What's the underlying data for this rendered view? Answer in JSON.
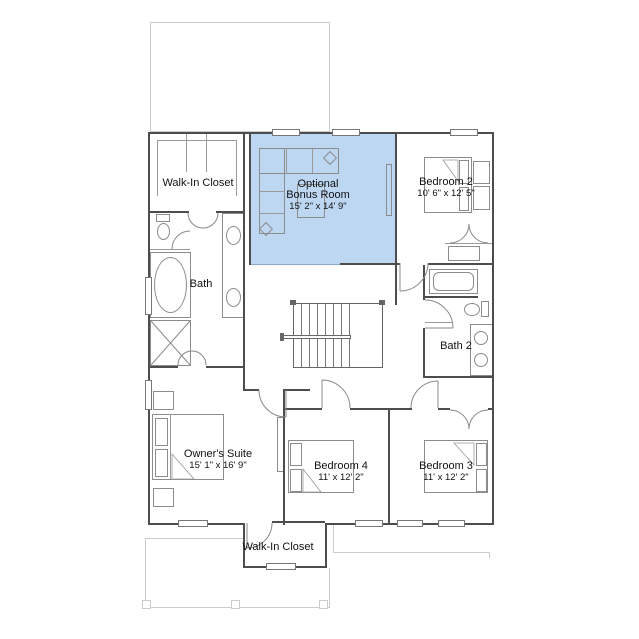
{
  "floorplan": {
    "rooms": {
      "walk_in_closet_upper": {
        "name": "Walk-In Closet"
      },
      "bonus_room": {
        "name_line1": "Optional",
        "name_line2": "Bonus Room",
        "dimensions": "15' 2\" x 14' 9\"",
        "is_highlighted_option": true
      },
      "bedroom_2": {
        "name": "Bedroom 2",
        "dimensions": "10' 6\" x 12' 5\""
      },
      "bath": {
        "name": "Bath"
      },
      "bath_2": {
        "name": "Bath 2"
      },
      "owners_suite": {
        "name": "Owner's Suite",
        "dimensions": "15' 1\" x 16' 9\""
      },
      "bedroom_4": {
        "name": "Bedroom 4",
        "dimensions": "11' x 12' 2\""
      },
      "bedroom_3": {
        "name": "Bedroom 3",
        "dimensions": "11' x 12' 2\""
      },
      "walk_in_closet_lower": {
        "name": "Walk-In Closet"
      }
    },
    "colors": {
      "highlight_fill": "#bdd7f3",
      "wall": "#4d4d4d",
      "fixture_line": "#8c8c8c",
      "light_outline": "#cccccc",
      "label_text": "#111111"
    }
  }
}
